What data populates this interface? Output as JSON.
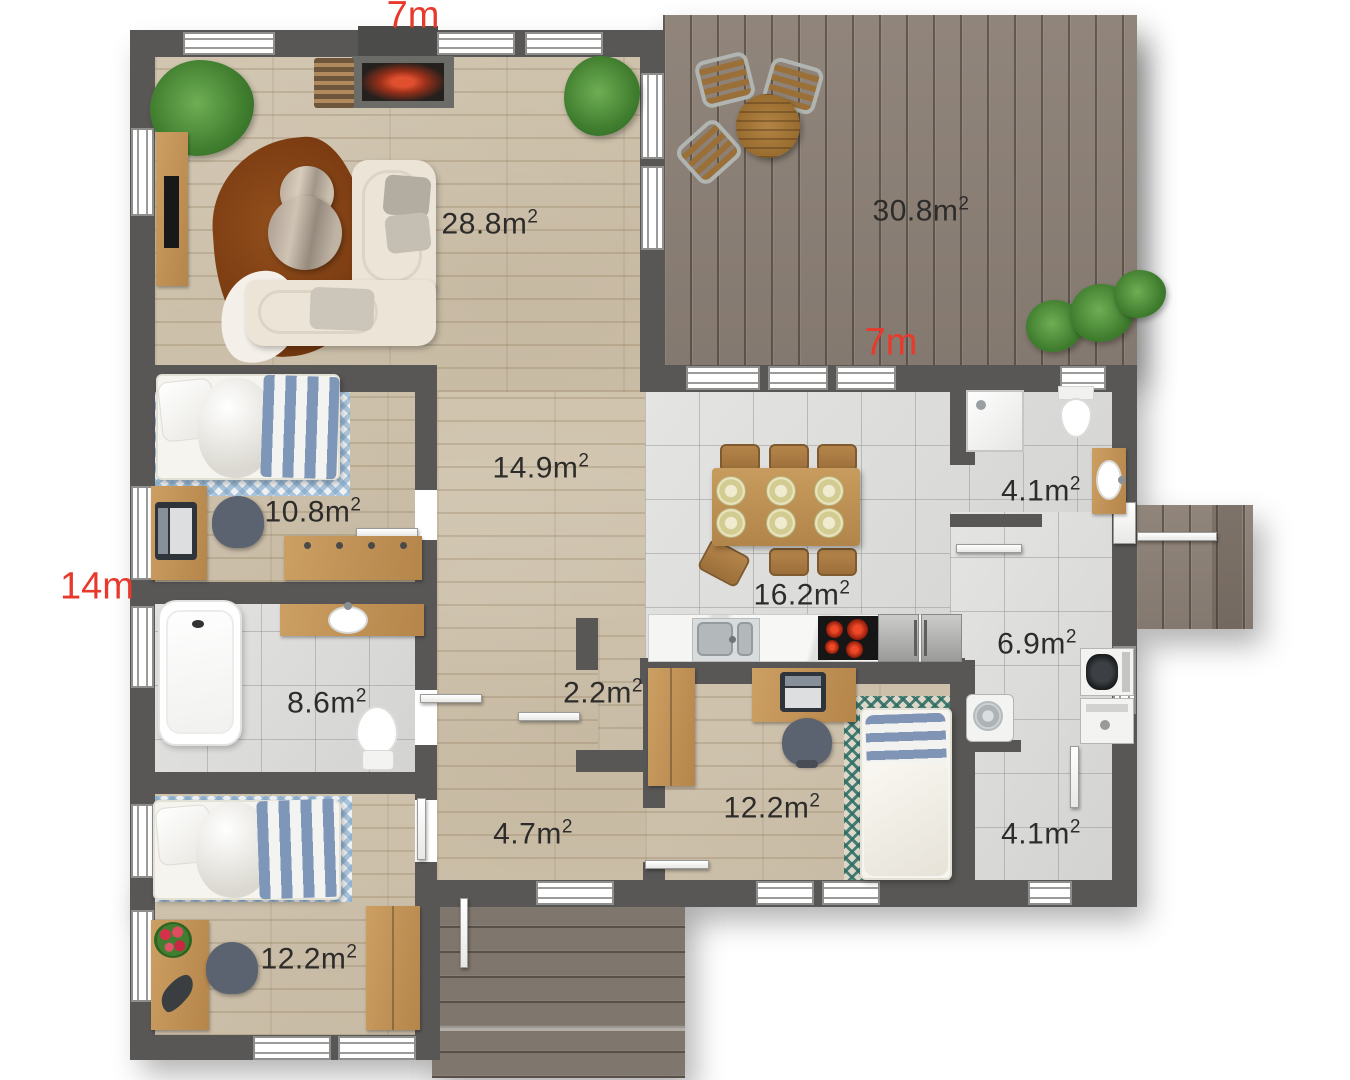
{
  "page": {
    "type": "floor-plan"
  },
  "dimensions": {
    "top": "7m",
    "middle": "7m",
    "left": "14m"
  },
  "rooms": [
    {
      "name": "living-room",
      "area": "28.8m",
      "sup": "2"
    },
    {
      "name": "terrace",
      "area": "30.8m",
      "sup": "2"
    },
    {
      "name": "hall",
      "area": "14.9m",
      "sup": "2"
    },
    {
      "name": "bedroom-upper-left",
      "area": "10.8m",
      "sup": "2"
    },
    {
      "name": "kitchen-dining",
      "area": "16.2m",
      "sup": "2"
    },
    {
      "name": "bathroom-top-right",
      "area": "4.1m",
      "sup": "2"
    },
    {
      "name": "bathroom-left",
      "area": "8.6m",
      "sup": "2"
    },
    {
      "name": "closet",
      "area": "2.2m",
      "sup": "2"
    },
    {
      "name": "utility-room",
      "area": "6.9m",
      "sup": "2"
    },
    {
      "name": "bedroom-center",
      "area": "12.2m",
      "sup": "2"
    },
    {
      "name": "hallway",
      "area": "4.7m",
      "sup": "2"
    },
    {
      "name": "storage",
      "area": "4.1m",
      "sup": "2"
    },
    {
      "name": "bedroom-bottom-left",
      "area": "12.2m",
      "sup": "2"
    }
  ],
  "colors": {
    "dimension_label": "#e73a2c",
    "area_label": "#2d2c2a",
    "wall": "#585755",
    "wood_floor": "#cfc3ad",
    "tile_floor": "#dbdbd9",
    "terrace_deck": "#8c8076",
    "porch_deck": "#7f776d"
  }
}
